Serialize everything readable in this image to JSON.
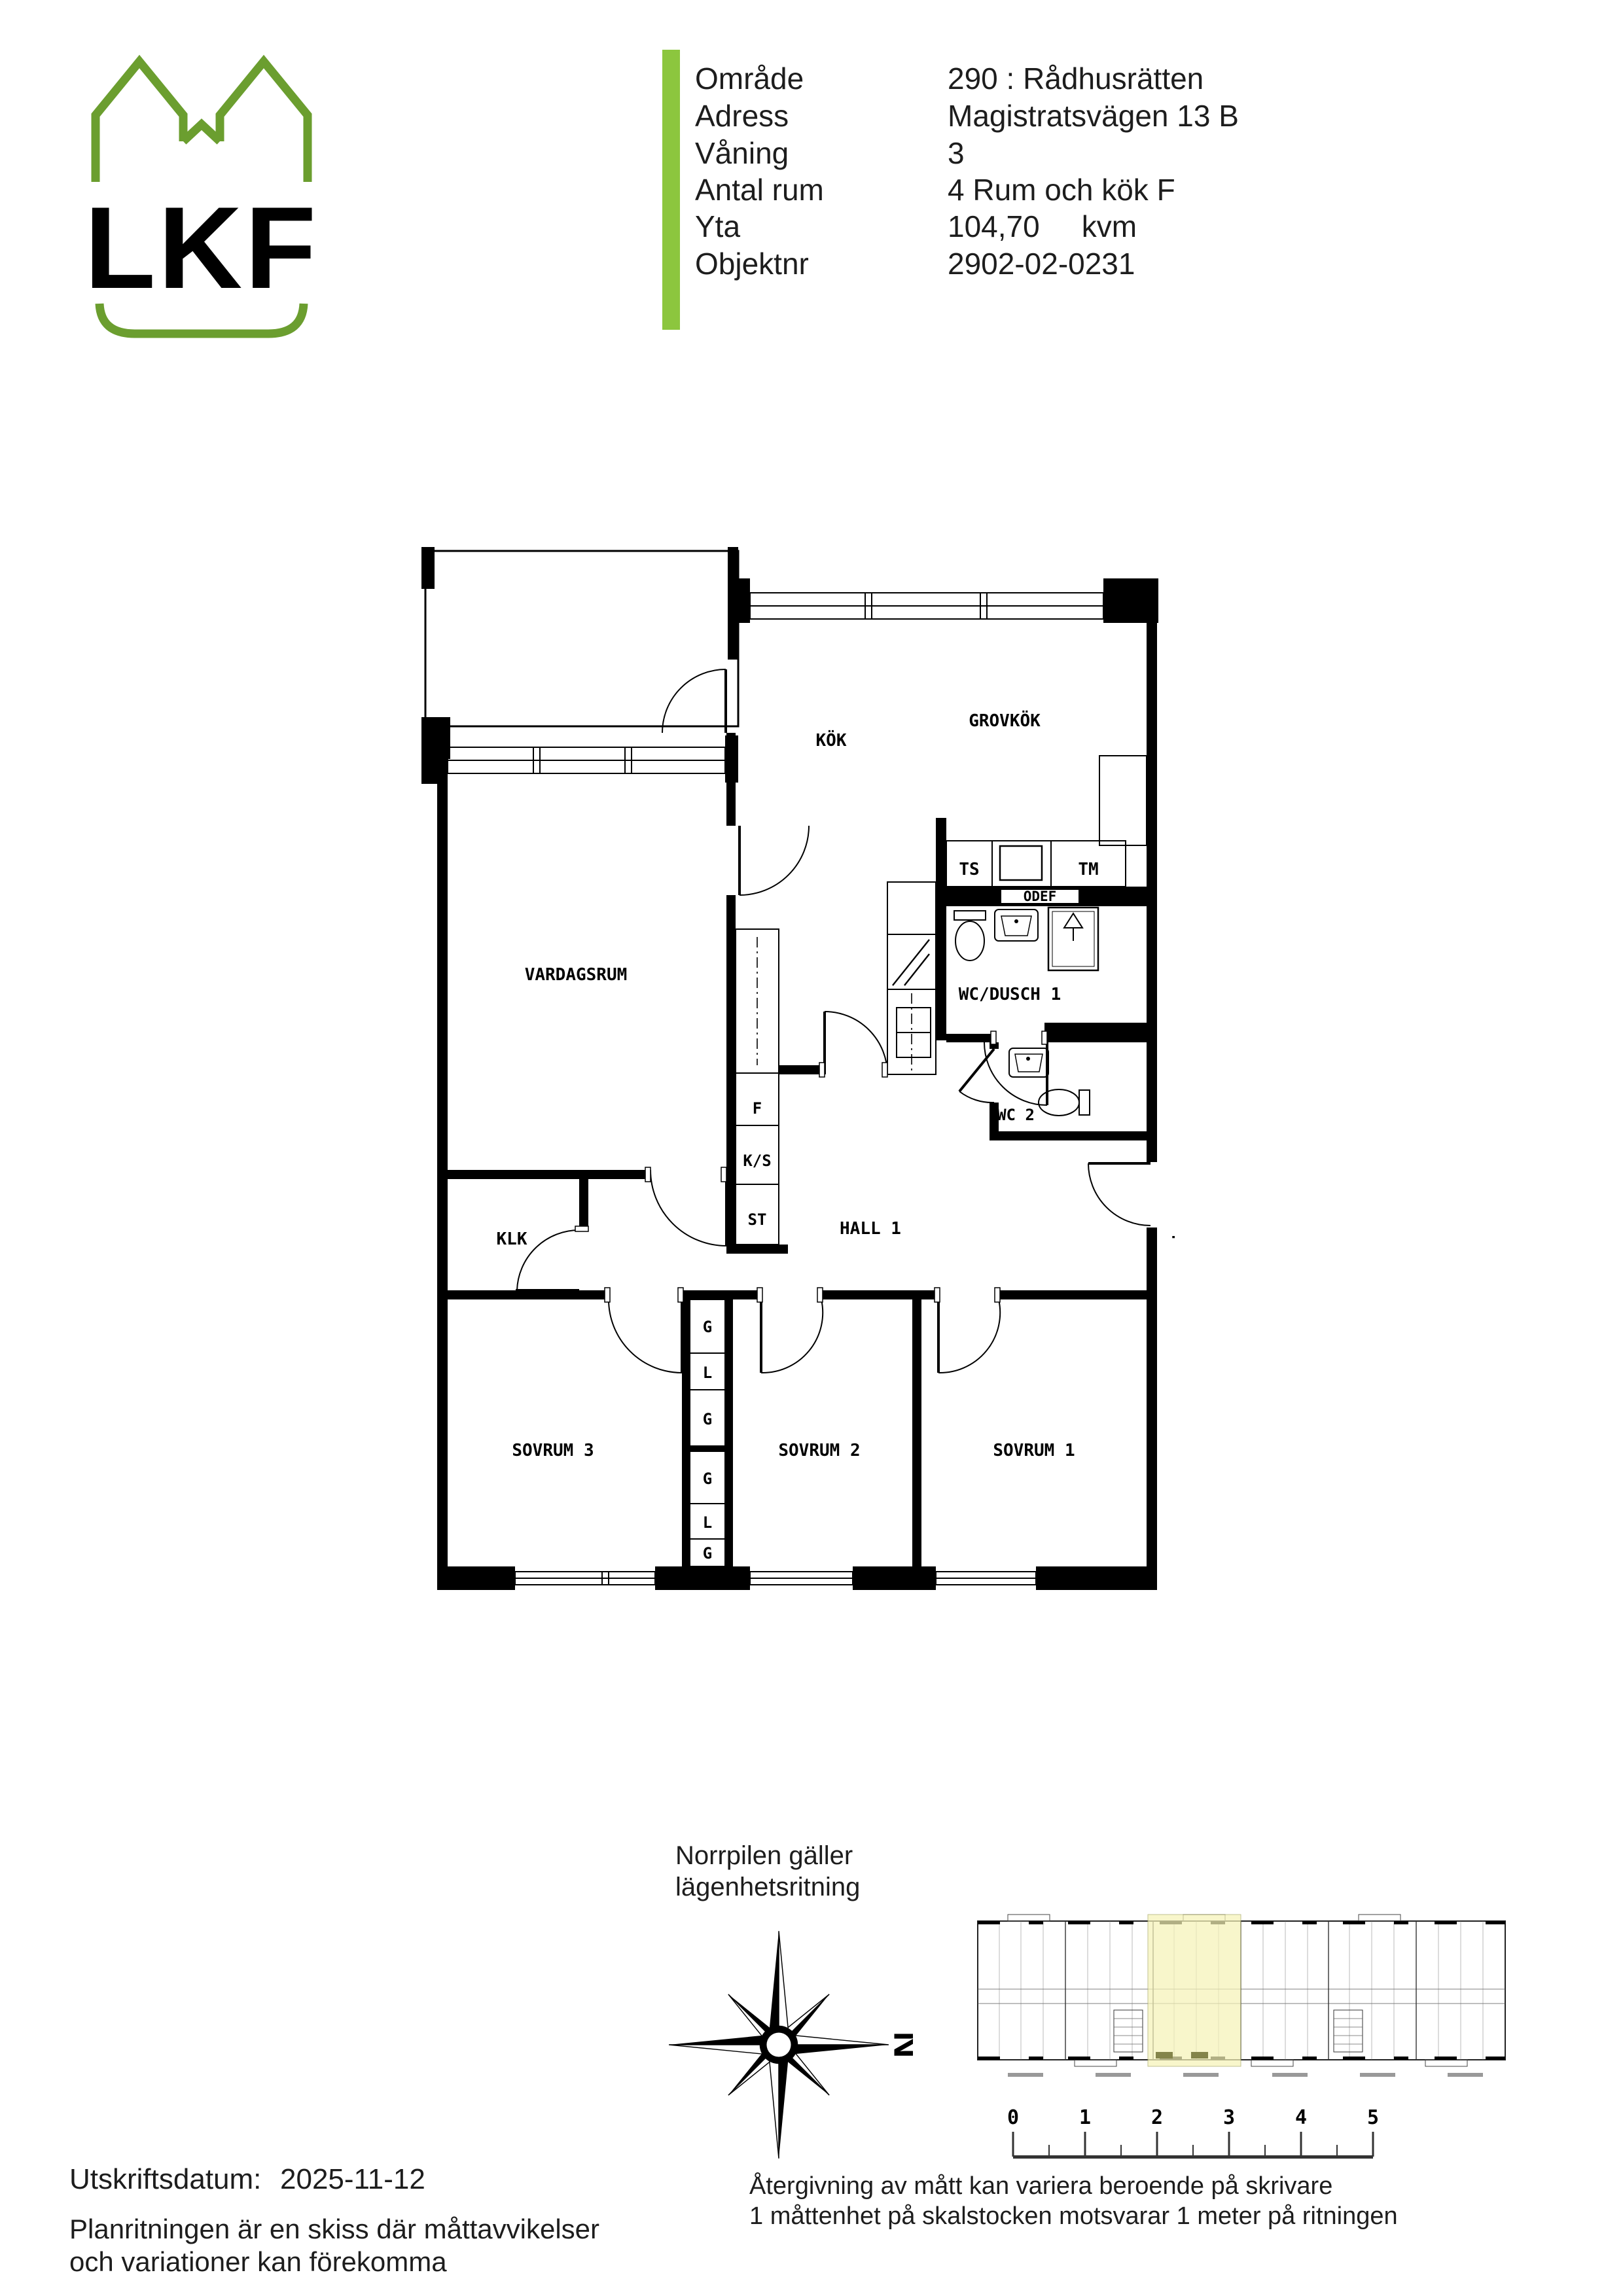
{
  "header": {
    "logo_text": "LKF",
    "rows": [
      {
        "label": "Område",
        "value": "290 : Rådhusrätten"
      },
      {
        "label": "Adress",
        "value": "Magistratsvägen 13 B"
      },
      {
        "label": "Våning",
        "value": "3"
      },
      {
        "label": "Antal rum",
        "value": "4 Rum och kök F"
      },
      {
        "label": "Yta",
        "value": "104,70",
        "unit": "kvm"
      },
      {
        "label": "Objektnr",
        "value": "2902-02-0231"
      }
    ]
  },
  "plan": {
    "rooms": {
      "vardagsrum": "VARDAGSRUM",
      "kok": "KÖK",
      "grovkok": "GROVKÖK",
      "wc_dusch": "WC/DUSCH 1",
      "wc2": "WC 2",
      "hall": "HALL 1",
      "klk": "KLK",
      "sovrum1": "SOVRUM 1",
      "sovrum2": "SOVRUM 2",
      "sovrum3": "SOVRUM 3"
    },
    "fixtures": {
      "ts": "TS",
      "tm": "TM",
      "odef": "ODEF",
      "f": "F",
      "ks": "K/S",
      "st": "ST",
      "entrance": "T"
    },
    "closet": [
      "G",
      "L",
      "G",
      "G",
      "L",
      "G"
    ]
  },
  "footer": {
    "north_note": [
      "Norrpilen gäller",
      "lägenhetsritning"
    ],
    "compass_letter": "N",
    "scale_ticks": [
      "0",
      "1",
      "2",
      "3",
      "4",
      "5"
    ],
    "scale_caption": [
      "Återgivning av mått kan variera beroende på skrivare",
      "1 måttenhet på skalstocken motsvarar 1 meter på ritningen"
    ],
    "print_label": "Utskriftsdatum:",
    "print_date": "2025-11-12",
    "disclaimer": [
      "Planritningen är en skiss där måttavvikelser",
      "och variationer kan förekomma"
    ]
  },
  "colors": {
    "logo_green": "#6B9E2F",
    "bar_green": "#8CC63E",
    "highlight_yellow": "#F6F3B8"
  }
}
